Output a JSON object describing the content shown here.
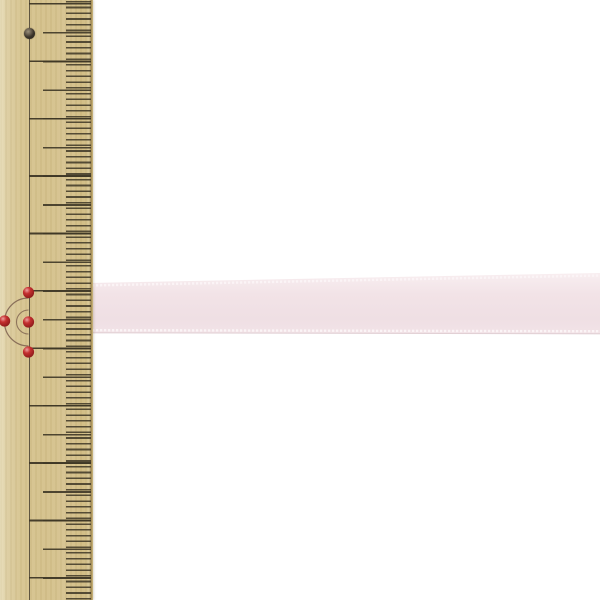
{
  "scene": {
    "description": "Product photo: a pale pink satin ribbon laid horizontally across a vertical wooden ruler with millimetre tick marks, on a plain white background",
    "background_color": "#ffffff"
  },
  "ruler": {
    "kind": "wooden sewing ruler, vertical, along left edge",
    "wood_color": "#d6c38e",
    "wood_highlight": "#eae0bc",
    "wood_edge_shadow": "#a18a54",
    "tick_color": "#453d2b",
    "guide_line_color": "#4a4131",
    "tick_spacing_px": {
      "mm1": 5.74,
      "mm5": 28.7,
      "mm10": 57.4
    },
    "hole": {
      "ring_color": "#8d8472",
      "core_color": "#2b261e"
    }
  },
  "pins": {
    "count": 4,
    "head_color": "#c53030",
    "head_highlight": "#eda0a0",
    "head_dark": "#7e1414",
    "arc_color": "#75594a"
  },
  "ribbon": {
    "material": "satin, picot woven edges",
    "color": "#f2e3e7",
    "color_light": "#f8eef0",
    "color_deep": "#efdfe4",
    "stitch_color": "#fbf4f6",
    "edge_shadow_color": "#dcc9ce",
    "approx_width_mm": 9
  }
}
